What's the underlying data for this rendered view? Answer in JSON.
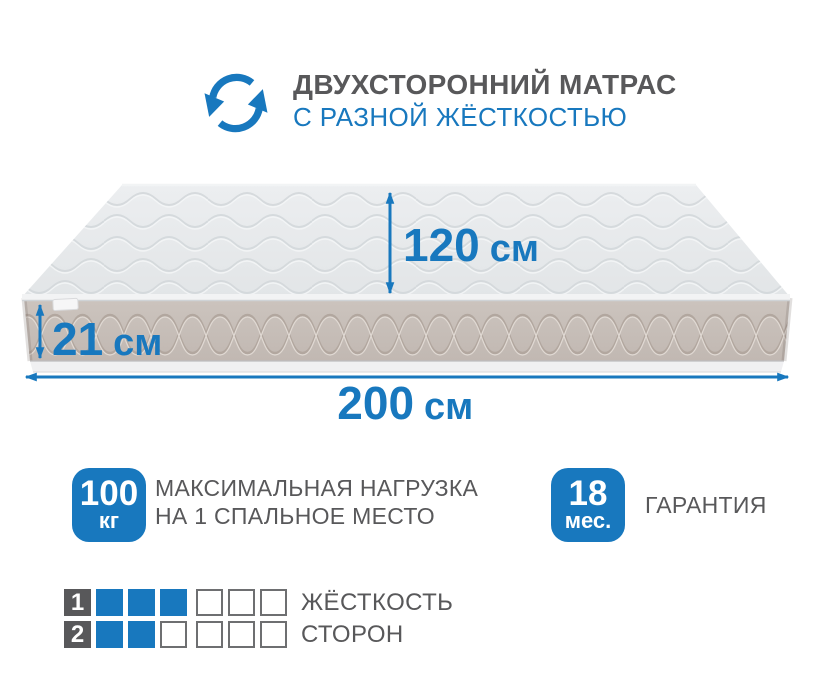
{
  "colors": {
    "accent_blue": "#1878BE",
    "text_gray": "#58585A",
    "square_border": "#6E6F71",
    "mattress_top": "#E8EAEC",
    "mattress_side": "#C9C0BA"
  },
  "header": {
    "icon": "two-sided-arrows-icon",
    "title": "ДВУХСТОРОННИЙ МАТРАС",
    "subtitle": "С РАЗНОЙ ЖЁСТКОСТЬЮ"
  },
  "mattress": {
    "width": {
      "value": "120",
      "unit": "см"
    },
    "height": {
      "value": "21",
      "unit": "см"
    },
    "length": {
      "value": "200",
      "unit": "см"
    }
  },
  "badges": {
    "max_load": {
      "value": "100",
      "unit": "кг",
      "label_line1": "МАКСИМАЛЬНАЯ НАГРУЗКА",
      "label_line2": "НА 1 СПАЛЬНОЕ МЕСТО"
    },
    "warranty": {
      "value": "18",
      "unit": "мес.",
      "label": "ГАРАНТИЯ"
    }
  },
  "firmness": {
    "label_line1": "ЖЁСТКОСТЬ",
    "label_line2": "СТОРОН",
    "scale_max": 6,
    "rows": [
      {
        "side": "1",
        "filled": 3
      },
      {
        "side": "2",
        "filled": 2
      }
    ]
  }
}
